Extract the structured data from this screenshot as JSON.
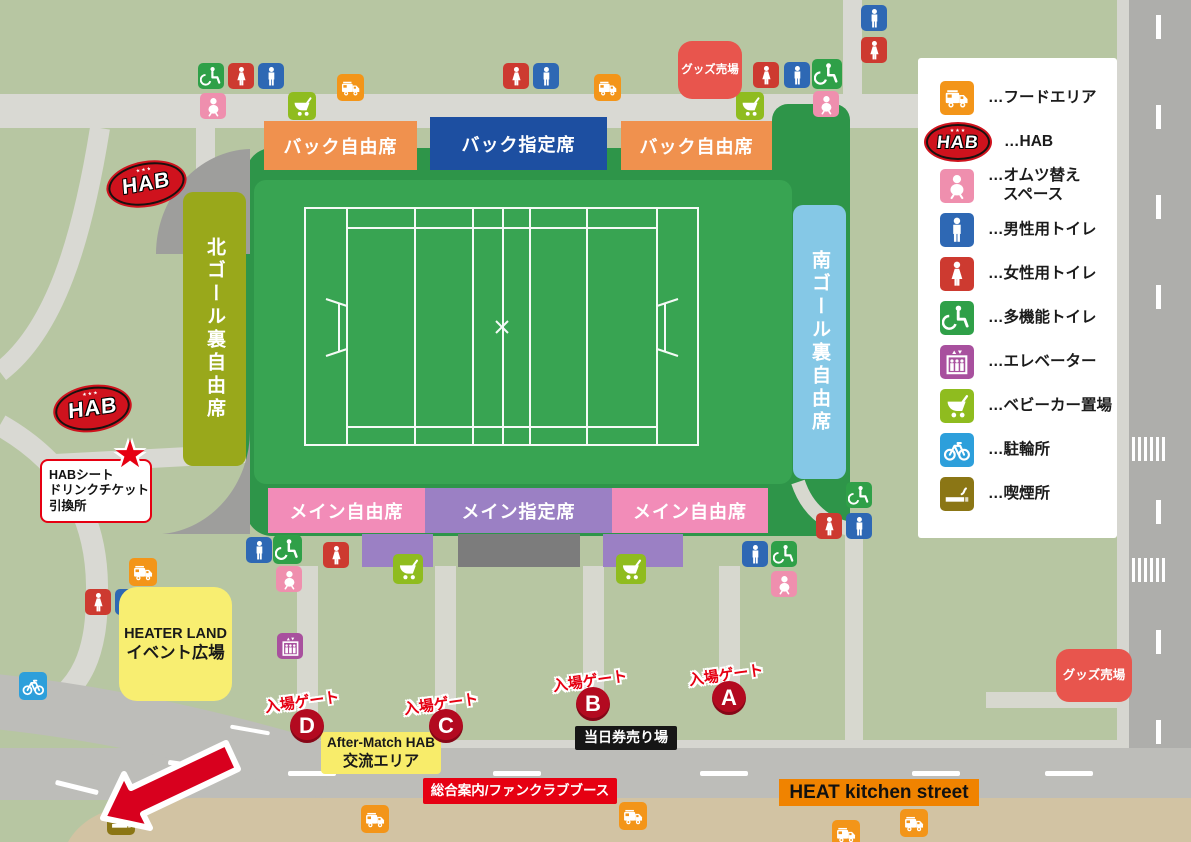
{
  "colors": {
    "background": "#b7c6a2",
    "stadium_bowl": "#2e9549",
    "pitch": "#38a452",
    "road_dark": "#aeaeab",
    "road_light": "#d9d9d3",
    "plaza_path": "#d7d8cf",
    "bottom_road": "#bdbdb9",
    "sand": "#d2c3a3",
    "gray_structure": "#9e9e9c",
    "gate_red": "#b30a20",
    "accent_red": "#e60012",
    "arrow_red": "#d8001e"
  },
  "icon_colors": {
    "man": "#2e68b4",
    "woman": "#cd3a30",
    "wheelchair": "#2fa048",
    "baby": "#ef8fae",
    "stroller": "#8fbc1f",
    "elevator": "#a8509e",
    "bicycle": "#2d9fdb",
    "smoking": "#8b7615",
    "foodtruck": "#f39519"
  },
  "legend": {
    "items": [
      {
        "icon": "foodtruck",
        "lines": [
          "…フードエリア"
        ]
      },
      {
        "icon": "hab",
        "lines": [
          "…HAB"
        ]
      },
      {
        "icon": "baby",
        "lines": [
          "…オムツ替え",
          "スペース"
        ]
      },
      {
        "icon": "man",
        "lines": [
          "…男性用トイレ"
        ]
      },
      {
        "icon": "woman",
        "lines": [
          "…女性用トイレ"
        ]
      },
      {
        "icon": "wheelchair",
        "lines": [
          "…多機能トイレ"
        ]
      },
      {
        "icon": "elevator",
        "lines": [
          "…エレベーター"
        ]
      },
      {
        "icon": "stroller",
        "lines": [
          "…ベビーカー置場"
        ]
      },
      {
        "icon": "bicycle",
        "lines": [
          "…駐輪所"
        ]
      },
      {
        "icon": "smoking",
        "lines": [
          "…喫煙所"
        ]
      }
    ]
  },
  "stands": [
    {
      "name": "back-free-left",
      "label": "バック自由席",
      "x": 264,
      "y": 121,
      "w": 153,
      "h": 49,
      "bg": "#f0914e"
    },
    {
      "name": "back-reserved",
      "label": "バック指定席",
      "x": 430,
      "y": 117,
      "w": 177,
      "h": 53,
      "bg": "#1d4fa1"
    },
    {
      "name": "back-free-right",
      "label": "バック自由席",
      "x": 621,
      "y": 121,
      "w": 151,
      "h": 49,
      "bg": "#f0914e"
    },
    {
      "name": "main-free-left",
      "label": "メイン自由席",
      "x": 268,
      "y": 488,
      "w": 157,
      "h": 45,
      "bg": "#f28cb8"
    },
    {
      "name": "main-reserved",
      "label": "メイン指定席",
      "x": 425,
      "y": 488,
      "w": 187,
      "h": 45,
      "bg": "#9b80c4"
    },
    {
      "name": "main-free-right",
      "label": "メイン自由席",
      "x": 612,
      "y": 488,
      "w": 156,
      "h": 45,
      "bg": "#f28cb8"
    },
    {
      "name": "north-goal-free",
      "label": "北ゴール裏自由席",
      "x": 183,
      "y": 192,
      "w": 63,
      "h": 274,
      "bg": "#99a81b",
      "vertical": true
    },
    {
      "name": "south-goal-free",
      "label": "南ゴール裏自由席",
      "x": 793,
      "y": 205,
      "w": 53,
      "h": 274,
      "bg": "#85c8e6",
      "vertical": true
    }
  ],
  "aux_blocks": [
    {
      "x": 362,
      "y": 534,
      "w": 71,
      "h": 33,
      "bg": "#9b80c4"
    },
    {
      "x": 458,
      "y": 534,
      "w": 122,
      "h": 33,
      "bg": "#7c7c7c"
    },
    {
      "x": 603,
      "y": 534,
      "w": 80,
      "h": 33,
      "bg": "#9b80c4"
    }
  ],
  "facilities": [
    {
      "name": "goods-shop-top",
      "lines": [
        "グッズ売場"
      ],
      "x": 678,
      "y": 41,
      "w": 64,
      "h": 58,
      "bg": "#e8554d",
      "color": "#fff",
      "fs": 11.5,
      "radius": 14
    },
    {
      "name": "goods-shop-right",
      "lines": [
        "グッズ売場"
      ],
      "x": 1056,
      "y": 649,
      "w": 76,
      "h": 53,
      "bg": "#e8554d",
      "color": "#fff",
      "fs": 12.5,
      "radius": 13
    },
    {
      "name": "heater-land",
      "lines": [
        "HEATER LAND",
        "イベント広場"
      ],
      "x": 119,
      "y": 587,
      "w": 113,
      "h": 114,
      "bg": "#f8ee71",
      "color": "#191919",
      "fs": 14.5,
      "radius": 18
    },
    {
      "name": "after-match-area",
      "lines": [
        "After-Match HAB",
        "交流エリア"
      ],
      "x": 321,
      "y": 732,
      "w": 120,
      "h": 42,
      "bg": "#f8ec6a",
      "color": "#191919",
      "fs": 13.5,
      "radius": 4
    },
    {
      "name": "day-ticket-booth",
      "lines": [
        "当日券売り場"
      ],
      "x": 575,
      "y": 726,
      "w": 102,
      "h": 24,
      "bg": "#161616",
      "color": "#fff",
      "fs": 14,
      "radius": 2
    },
    {
      "name": "info-fanclub-booth",
      "lines": [
        "総合案内/ファンクラブブース"
      ],
      "x": 423,
      "y": 778,
      "w": 194,
      "h": 26,
      "bg": "#e60012",
      "color": "#fff",
      "fs": 13.5,
      "radius": 2
    },
    {
      "name": "heat-kitchen-street",
      "lines": [
        "HEAT kitchen street"
      ],
      "x": 779,
      "y": 779,
      "w": 200,
      "h": 27,
      "bg": "#f08300",
      "color": "#111",
      "fs": 19,
      "radius": 0
    },
    {
      "name": "hab-seat-exchange",
      "lines": [
        "HABシート",
        "ドリンクチケット",
        "引換所"
      ],
      "x": 40,
      "y": 459,
      "w": 112,
      "h": 64,
      "bg": "#ffffff",
      "color": "#111",
      "fs": 12.5,
      "radius": 8,
      "border": "2px solid #e60012",
      "align": "left"
    }
  ],
  "gates": {
    "label": "入場ゲート",
    "items": [
      {
        "letter": "D",
        "cx": 307,
        "cy": 726,
        "lx": 302,
        "ly": 701
      },
      {
        "letter": "C",
        "cx": 446,
        "cy": 726,
        "lx": 441,
        "ly": 703
      },
      {
        "letter": "B",
        "cx": 593,
        "cy": 704,
        "lx": 590,
        "ly": 680
      },
      {
        "letter": "A",
        "cx": 729,
        "cy": 698,
        "lx": 726,
        "ly": 674
      }
    ]
  },
  "hab": {
    "text": "HAB",
    "mini": "★★★",
    "logos": [
      {
        "x": 108,
        "y": 163,
        "w": 77,
        "h": 42,
        "rot": -10
      },
      {
        "x": 55,
        "y": 387,
        "w": 75,
        "h": 43,
        "rot": -8
      }
    ],
    "star": {
      "glyph": "★",
      "x": 113,
      "y": 436,
      "size": 38
    }
  },
  "map_icons": [
    {
      "t": "wheelchair",
      "x": 198,
      "y": 63
    },
    {
      "t": "woman",
      "x": 228,
      "y": 63
    },
    {
      "t": "man",
      "x": 258,
      "y": 63
    },
    {
      "t": "baby",
      "x": 200,
      "y": 93
    },
    {
      "t": "stroller",
      "x": 288,
      "y": 92,
      "s": 28
    },
    {
      "t": "foodtruck",
      "x": 337,
      "y": 74,
      "s": 27
    },
    {
      "t": "woman",
      "x": 503,
      "y": 63
    },
    {
      "t": "man",
      "x": 533,
      "y": 63
    },
    {
      "t": "foodtruck",
      "x": 594,
      "y": 74,
      "s": 27
    },
    {
      "t": "stroller",
      "x": 736,
      "y": 92,
      "s": 28
    },
    {
      "t": "woman",
      "x": 753,
      "y": 62
    },
    {
      "t": "man",
      "x": 784,
      "y": 62
    },
    {
      "t": "wheelchair",
      "x": 812,
      "y": 59,
      "s": 30
    },
    {
      "t": "baby",
      "x": 813,
      "y": 91
    },
    {
      "t": "man",
      "x": 861,
      "y": 5
    },
    {
      "t": "woman",
      "x": 861,
      "y": 37
    },
    {
      "t": "man",
      "x": 246,
      "y": 537
    },
    {
      "t": "wheelchair",
      "x": 273,
      "y": 535,
      "s": 29
    },
    {
      "t": "baby",
      "x": 276,
      "y": 566
    },
    {
      "t": "woman",
      "x": 323,
      "y": 542
    },
    {
      "t": "stroller",
      "x": 393,
      "y": 554,
      "s": 30
    },
    {
      "t": "stroller",
      "x": 616,
      "y": 554,
      "s": 30
    },
    {
      "t": "man",
      "x": 742,
      "y": 541
    },
    {
      "t": "wheelchair",
      "x": 771,
      "y": 541
    },
    {
      "t": "baby",
      "x": 771,
      "y": 571
    },
    {
      "t": "wheelchair",
      "x": 846,
      "y": 482
    },
    {
      "t": "woman",
      "x": 816,
      "y": 513
    },
    {
      "t": "man",
      "x": 846,
      "y": 513
    },
    {
      "t": "foodtruck",
      "x": 129,
      "y": 558,
      "s": 28
    },
    {
      "t": "woman",
      "x": 85,
      "y": 589
    },
    {
      "t": "man",
      "x": 115,
      "y": 589
    },
    {
      "t": "wheelchair",
      "x": 144,
      "y": 587,
      "s": 29
    },
    {
      "t": "elevator",
      "x": 277,
      "y": 633
    },
    {
      "t": "bicycle",
      "x": 19,
      "y": 672,
      "s": 28
    },
    {
      "t": "foodtruck",
      "x": 361,
      "y": 805,
      "s": 28
    },
    {
      "t": "foodtruck",
      "x": 619,
      "y": 802,
      "s": 28
    },
    {
      "t": "foodtruck",
      "x": 832,
      "y": 820,
      "s": 28
    },
    {
      "t": "foodtruck",
      "x": 900,
      "y": 809,
      "s": 28
    },
    {
      "t": "smoking",
      "x": 107,
      "y": 807,
      "s": 28
    }
  ]
}
